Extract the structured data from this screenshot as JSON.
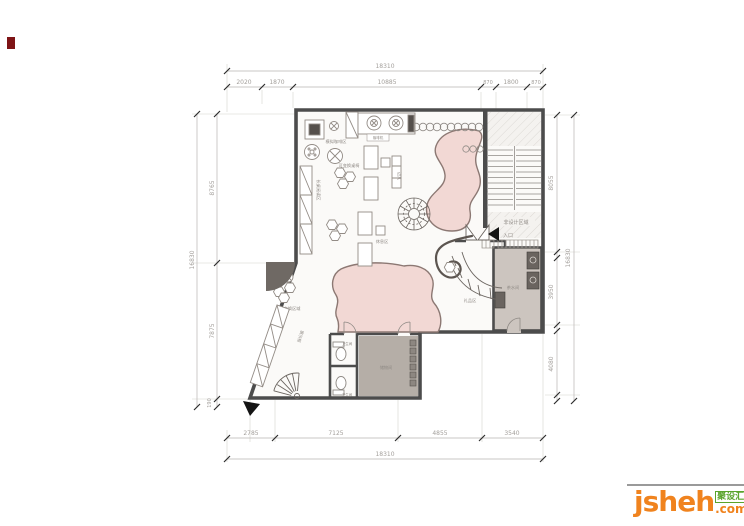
{
  "dims": {
    "top_total": "18310",
    "top_segments": [
      "2020",
      "1870",
      "10885",
      "870",
      "1800",
      "870"
    ],
    "left_segments": [
      "8765",
      "7875",
      "190"
    ],
    "left_total": "16830",
    "right_segments": [
      "8055",
      "3950",
      "4080"
    ],
    "right_total": "16830",
    "bottom_segments": [
      "2785",
      "7125",
      "4855",
      "3540"
    ],
    "bottom_total": "18310"
  },
  "labels": {
    "non_design": "非设计区域",
    "entrance": "入口",
    "coffee_corner": "模拟咖啡区",
    "flex_tables": "可变换桌椅",
    "coffee_machine": "咖啡机",
    "reading_counter": "长桌阅读区",
    "side_table": "边几",
    "rest_area": "休息区",
    "flex_zone": "可变换区域",
    "display_cabinet": "展示柜",
    "gift_area": "礼品区",
    "pantry": "茶水间",
    "storage": "储物间",
    "wc_upper": "卫生间",
    "wc_lower": "卫生间"
  },
  "logo": {
    "brand": "jsheh",
    "tld": ".com",
    "badge": "聚设汇"
  },
  "colors": {
    "wall": "#4c4c4c",
    "pink_room": "#f2d8d4",
    "gray_room": "#b5aea7",
    "pantry_room": "#ccc5bf",
    "brand_orange": "#f0831e",
    "badge_green": "#5aa42c",
    "red_mark": "#7e1416"
  }
}
